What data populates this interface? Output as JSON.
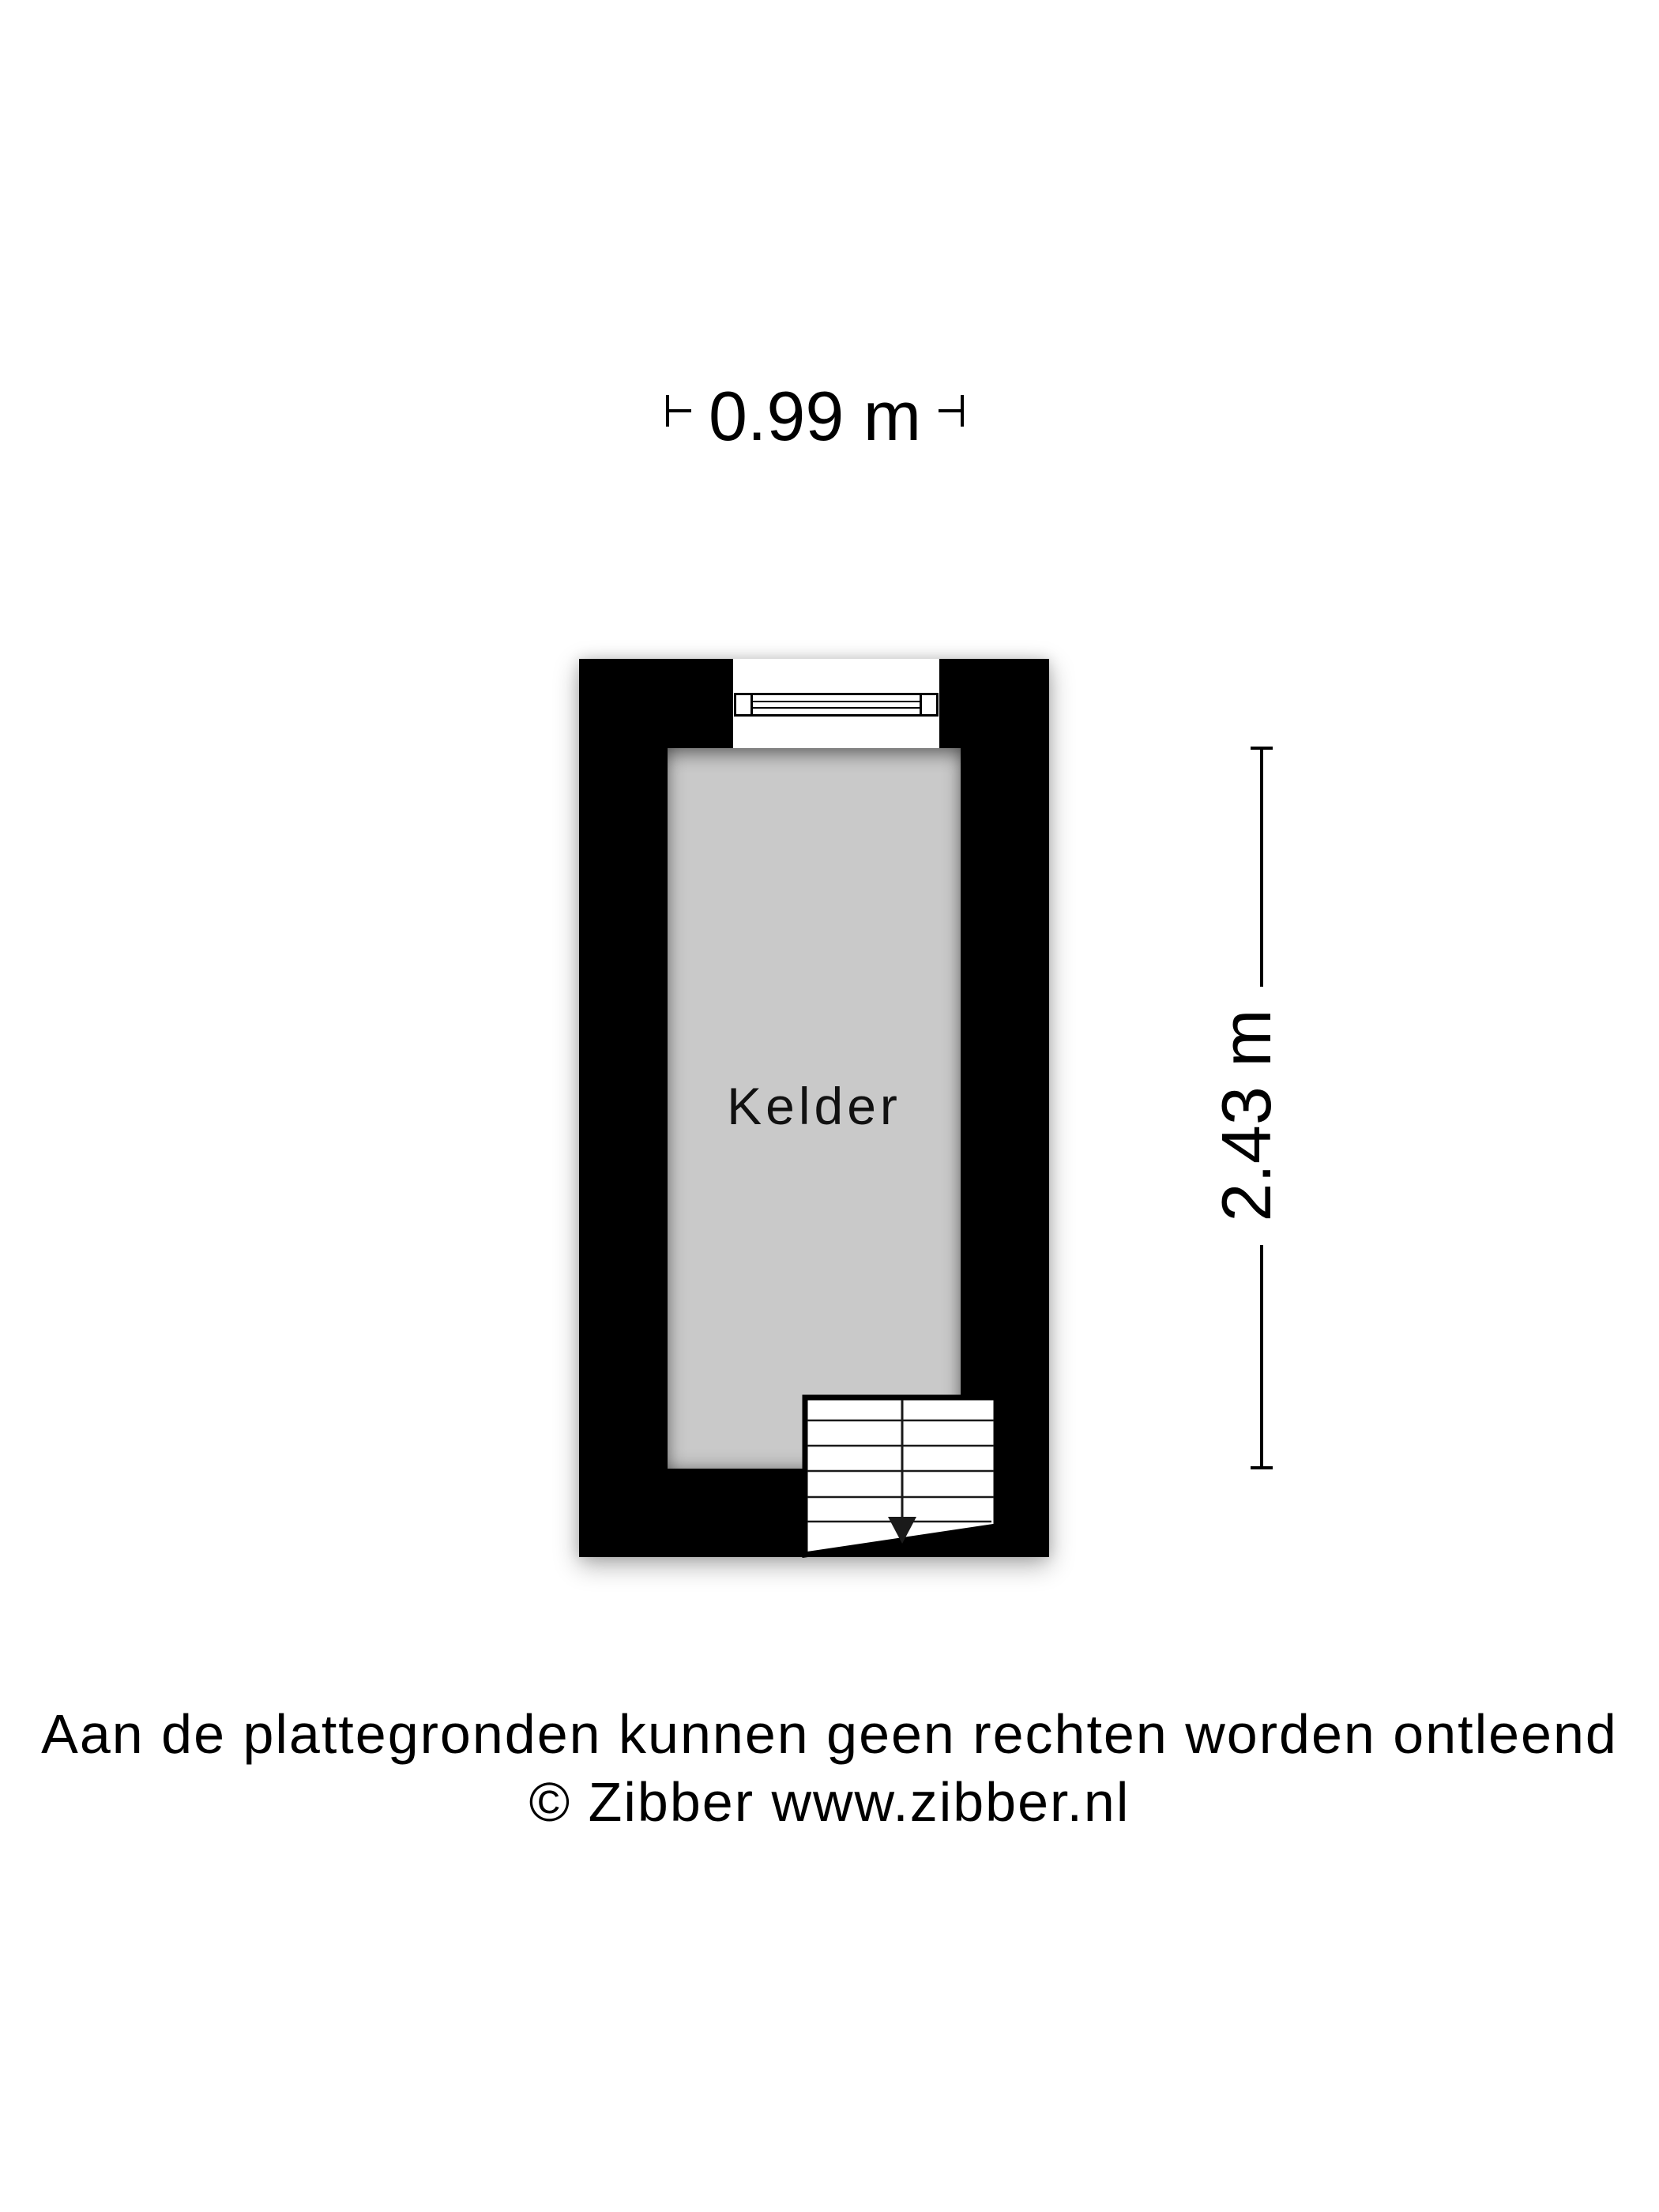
{
  "floorplan": {
    "room": {
      "label": "Kelder",
      "floor_color": "#c9c9c9"
    },
    "wall_color": "#000000",
    "background_color": "#ffffff",
    "dimensions": {
      "width_label": "0.99 m",
      "height_label": "2.43 m"
    },
    "icons": {
      "window": "window-icon",
      "stairs": "stairs-icon",
      "stairs_arrow": "arrow-down-icon",
      "dimension_ticks": "dimension-tick-icon"
    }
  },
  "footer": {
    "disclaimer": "Aan de plattegronden kunnen geen rechten worden ontleend",
    "copyright": "© Zibber www.zibber.nl"
  }
}
